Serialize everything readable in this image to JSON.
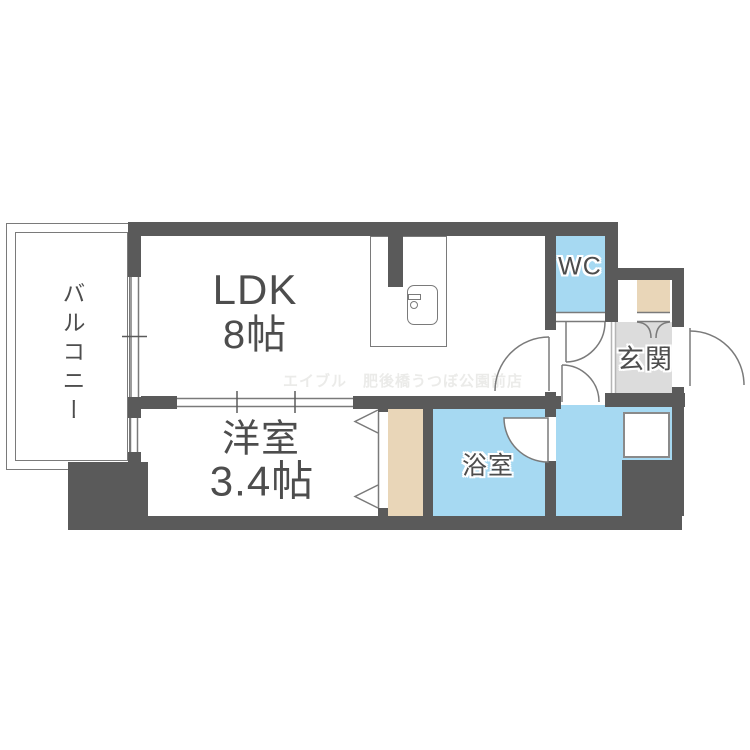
{
  "title": "apartment-floor-plan",
  "rooms": {
    "balcony": {
      "label": "バルコニー"
    },
    "ldk": {
      "label": "LDK",
      "size": "8帖"
    },
    "western": {
      "label": "洋室",
      "size": "3.4帖"
    },
    "wc": {
      "label": "WC"
    },
    "genkan": {
      "label": "玄関"
    },
    "bathroom": {
      "label": "浴室"
    }
  },
  "watermark": "エイブル　肥後橋うつぼ公園前店",
  "colors": {
    "wall": "#5a5a5a",
    "blue": "#a6d9f2",
    "beige": "#e9d6b8",
    "ggray": "#dcdcdc",
    "line": "#7a7a7a",
    "text": "#4d4d4d",
    "wm": "#ebebe9"
  }
}
